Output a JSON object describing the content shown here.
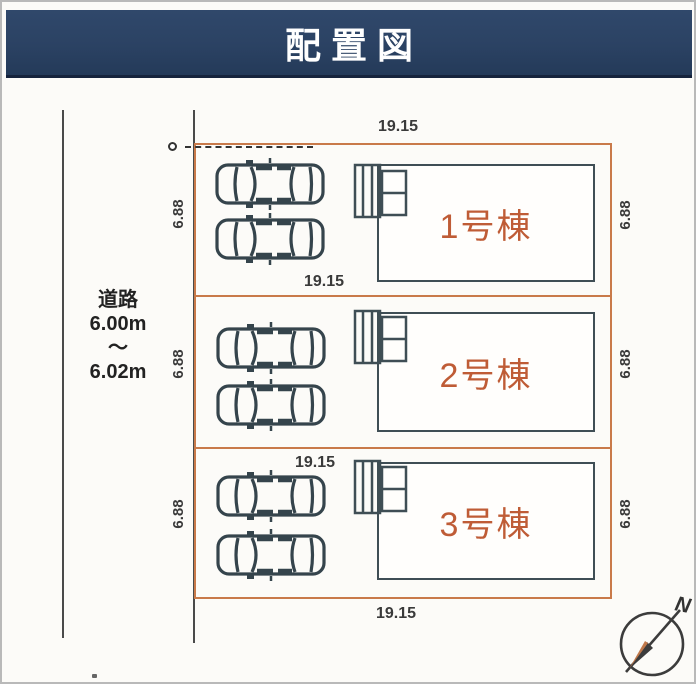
{
  "title": "配置図",
  "colors": {
    "title_bg": "#2b4263",
    "title_text": "#ffffff",
    "lot_border": "#c97a4a",
    "building_border": "#3f4e55",
    "building_label": "#bf5c36",
    "dimension_text": "#3a3a3a",
    "boundary_line": "#4a4a4a"
  },
  "road": {
    "name": "道路",
    "width_min": "6.00m",
    "tilde": "〜",
    "width_max": "6.02m"
  },
  "dimensions": {
    "top_width": "19.15",
    "mid_width": "19.15",
    "lot3_width": "19.15",
    "bottom_width": "19.15",
    "lot1_depth_left": "6.88",
    "lot1_depth_right": "6.88",
    "lot2_depth_left": "6.88",
    "lot2_depth_right": "6.88",
    "lot3_depth_left": "6.88",
    "lot3_depth_right": "6.88"
  },
  "buildings": [
    {
      "label": "1号棟"
    },
    {
      "label": "2号棟"
    },
    {
      "label": "3号棟"
    }
  ],
  "compass": {
    "north_label": "N"
  }
}
